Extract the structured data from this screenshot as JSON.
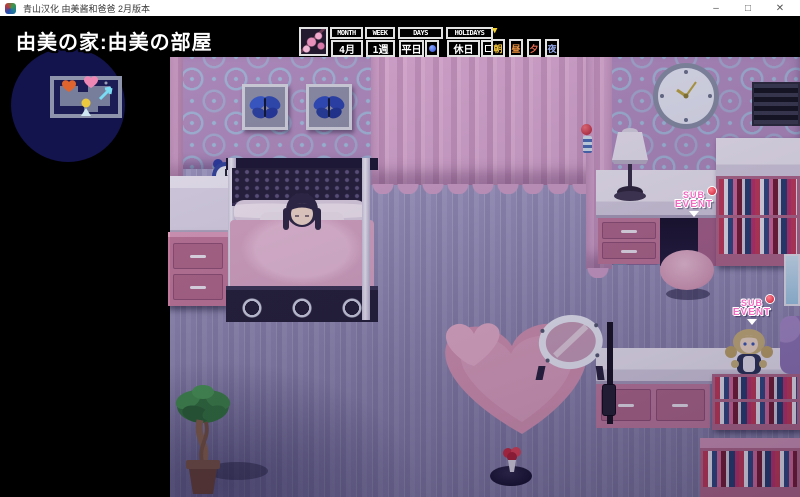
{
  "window": {
    "title": "青山汉化 由美酱和爸爸 2月版本",
    "controls": {
      "minimize": "–",
      "maximize": "□",
      "close": "✕"
    }
  },
  "hud": {
    "location": "由美の家:由美の部屋",
    "calendar": {
      "month_label": "MONTH",
      "month_value": "4月",
      "week_label": "WEEK",
      "week_value": "1週",
      "days_label": "DAYS",
      "days_value": "平日",
      "holidays_label": "HOLIDAYS",
      "holidays_value": "休日",
      "current_time_marker": "▼",
      "times": [
        {
          "label": "朝",
          "color": "#f2c43c",
          "current": true
        },
        {
          "label": "昼",
          "color": "#ef9440",
          "current": false
        },
        {
          "label": "夕",
          "color": "#e86a50",
          "current": false
        },
        {
          "label": "夜",
          "color": "#93a8e8",
          "current": false
        }
      ]
    }
  },
  "scene": {
    "sub_event_1": {
      "line1": "SUB",
      "line2": "EVENT"
    },
    "sub_event_2": {
      "line1": "SUB",
      "line2": "EVENT"
    }
  },
  "colors": {
    "titlebar_bg": "#ffffff",
    "game_bg": "#000000",
    "minimap_bg": "#13134d",
    "wall": "#b18dbd",
    "wall_pattern": "#9ec8e4",
    "curtain": "#d2a2c8",
    "floor": "#aba4c8",
    "accent_pink": "#c07898",
    "sub_event_text": "#f26bc1",
    "event_ball": "#d9303e",
    "hud_border": "#e2e2e2"
  }
}
